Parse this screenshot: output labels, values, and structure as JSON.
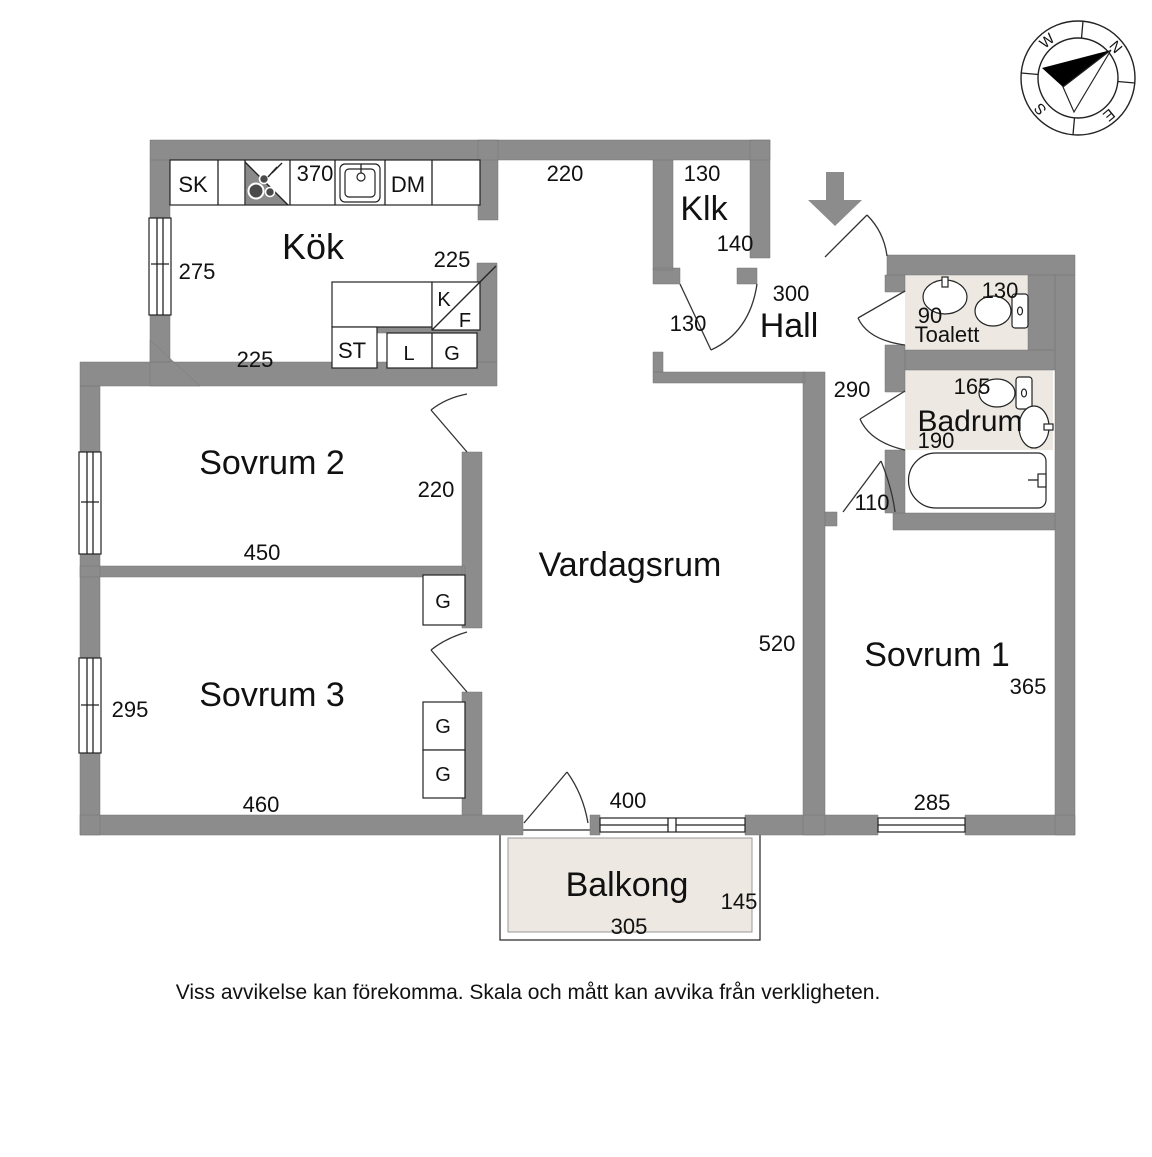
{
  "compass": {
    "n": "N",
    "e": "E",
    "s": "S",
    "w": "W"
  },
  "rooms": {
    "kok": {
      "label": "Kök"
    },
    "klk": {
      "label": "Klk"
    },
    "hall": {
      "label": "Hall"
    },
    "toalett": {
      "label": "Toalett"
    },
    "badrum": {
      "label": "Badrum"
    },
    "vardagsrum": {
      "label": "Vardagsrum"
    },
    "sovrum1": {
      "label": "Sovrum 1"
    },
    "sovrum2": {
      "label": "Sovrum 2"
    },
    "sovrum3": {
      "label": "Sovrum 3"
    },
    "balkong": {
      "label": "Balkong"
    }
  },
  "dimensions": {
    "kok_top": "370",
    "kok_left": "275",
    "kok_bottom": "225",
    "kok_kf": "225",
    "vardagsrum_top": "220",
    "vardagsrum_right": "520",
    "vardagsrum_bottom": "400",
    "klk_top": "130",
    "klk_bottom": "140",
    "hall_top": "300",
    "hall_left": "130",
    "hall_right": "290",
    "toalett_depth": "90",
    "toalett_width": "130",
    "badrum_top": "165",
    "badrum_bottom": "190",
    "sovrum2_bottom": "450",
    "sovrum2_right": "220",
    "sovrum3_left": "295",
    "sovrum3_bottom": "460",
    "sovrum1_door": "110",
    "sovrum1_right": "365",
    "sovrum1_bottom": "285",
    "balkong_bottom": "305",
    "balkong_right": "145"
  },
  "cabinets": {
    "sk": "SK",
    "dm": "DM",
    "k": "K",
    "f": "F",
    "st": "ST",
    "l": "L",
    "g_kok": "G",
    "g_vardagsrum_top": "G",
    "g_vardagsrum_mid": "G",
    "g_vardagsrum_bottom": "G"
  },
  "footer": {
    "disclaimer": "Viss avvikelse kan förekomma. Skala och mått kan avvika från verkligheten."
  },
  "colors": {
    "wall": "#8c8c8c",
    "wet": "#ede9e2",
    "floor": "#ffffff",
    "outline": "#222222",
    "ink": "#111111"
  }
}
